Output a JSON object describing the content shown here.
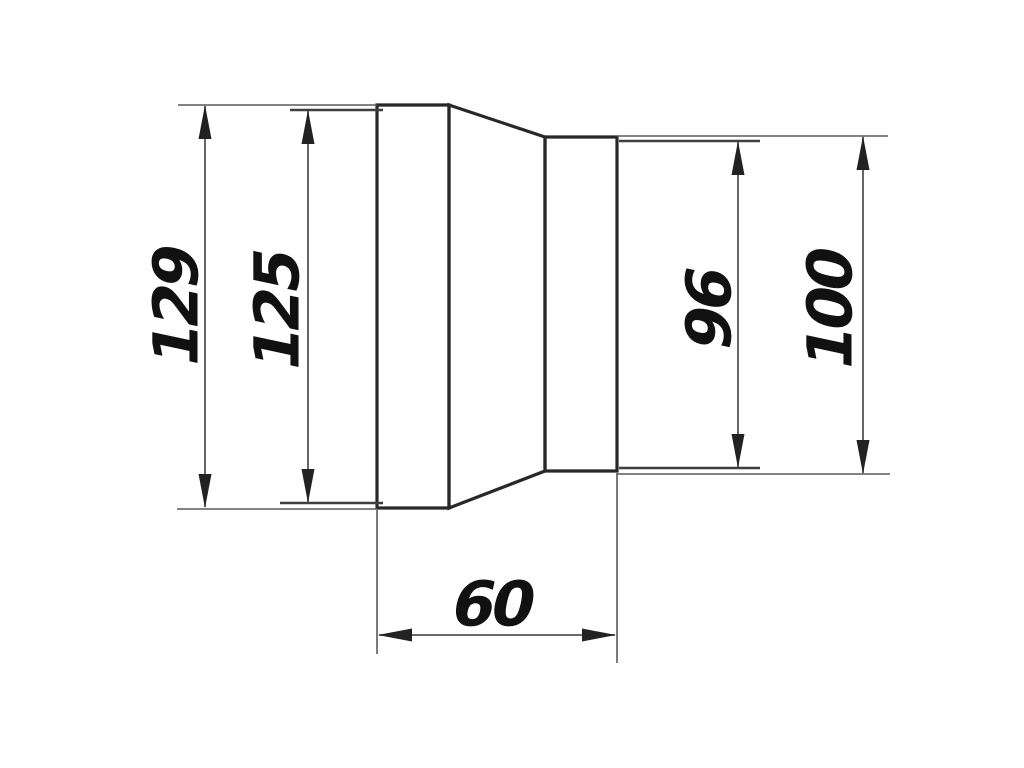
{
  "drawing": {
    "type": "technical-dimension-drawing",
    "dimensions": {
      "left_outer": "129",
      "left_inner": "125",
      "right_inner": "96",
      "right_outer": "100",
      "length": "60"
    },
    "colors": {
      "background": "#ffffff",
      "outline": "#282828",
      "dimension_lines": "#555555",
      "arrowheads": "#222222",
      "text": "#111111"
    }
  }
}
